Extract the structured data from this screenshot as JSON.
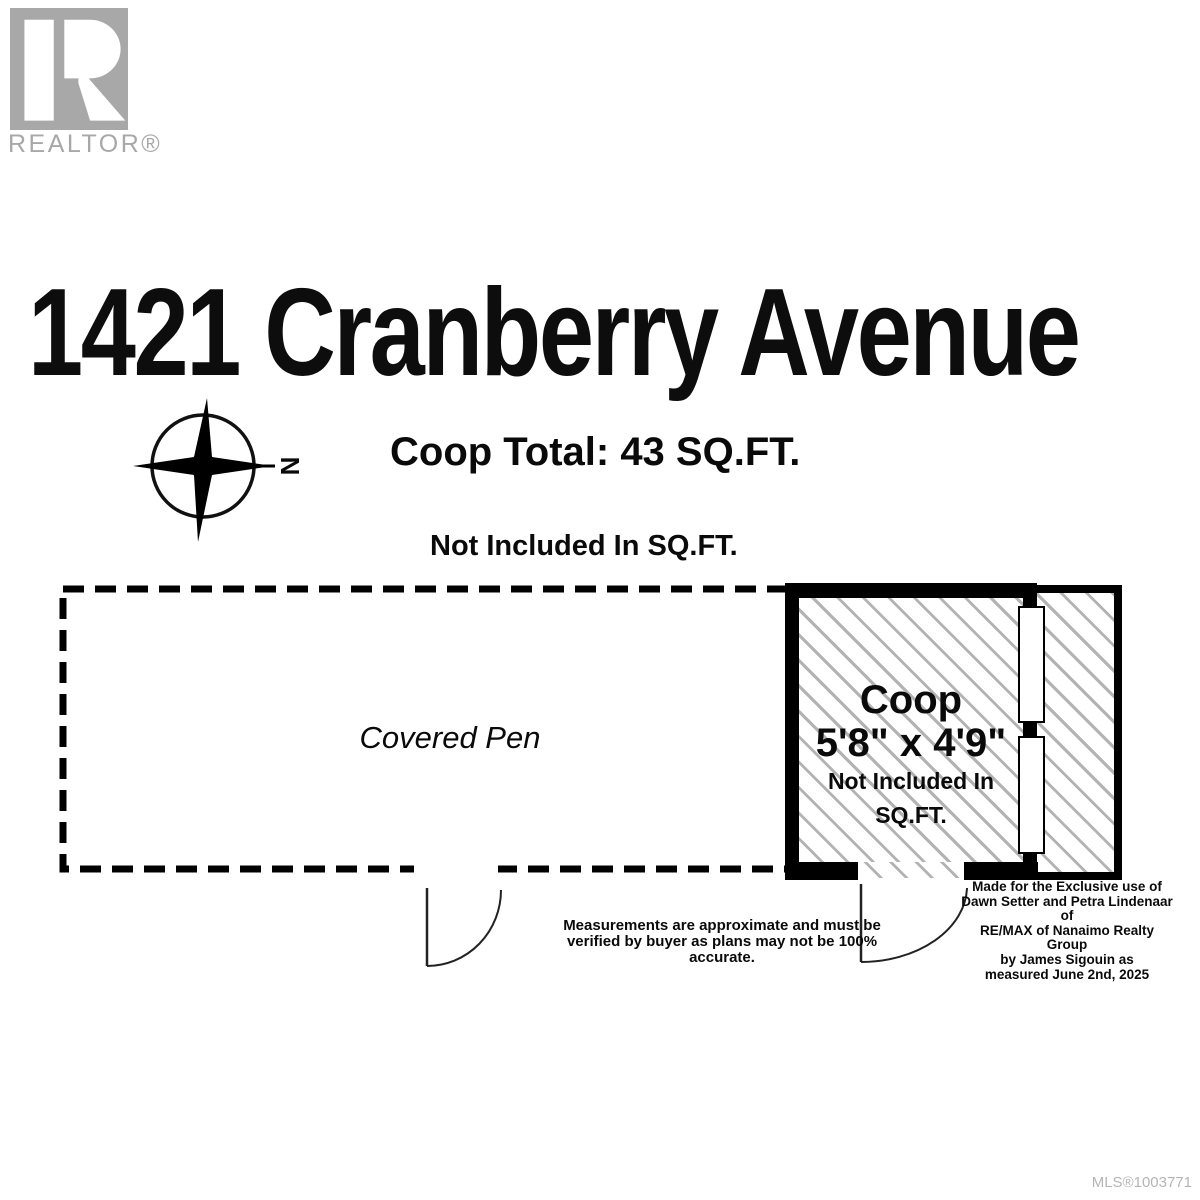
{
  "branding": {
    "logo_word": "REALTOR®"
  },
  "header": {
    "title": "1421 Cranberry Avenue"
  },
  "summary": {
    "coop_total": "Coop Total: 43 SQ.FT.",
    "not_included_heading": "Not Included In SQ.FT."
  },
  "compass": {
    "north_label": "N"
  },
  "plan": {
    "covered_pen_label": "Covered Pen",
    "coop": {
      "name": "Coop",
      "dimensions": "5'8\" x 4'9\"",
      "note": "Not Included In SQ.FT."
    }
  },
  "disclaimers": {
    "measurements_line1": "Measurements are approximate and must be",
    "measurements_line2": "verified by buyer as plans may not be 100% accurate.",
    "made_for_lines": [
      "Made for the Exclusive use of",
      "Dawn Setter and Petra Lindenaar  of",
      "RE/MAX of Nanaimo Realty Group",
      "by James Sigouin as",
      "measured June 2nd, 2025"
    ]
  },
  "footer": {
    "mls": "MLS®1003771"
  },
  "colors": {
    "wall_black": "#000000",
    "hatch_gray": "#b3b3b3",
    "logo_gray": "#a8a8a8",
    "mls_gray": "#b5b5b5",
    "door_line": "#222222"
  }
}
